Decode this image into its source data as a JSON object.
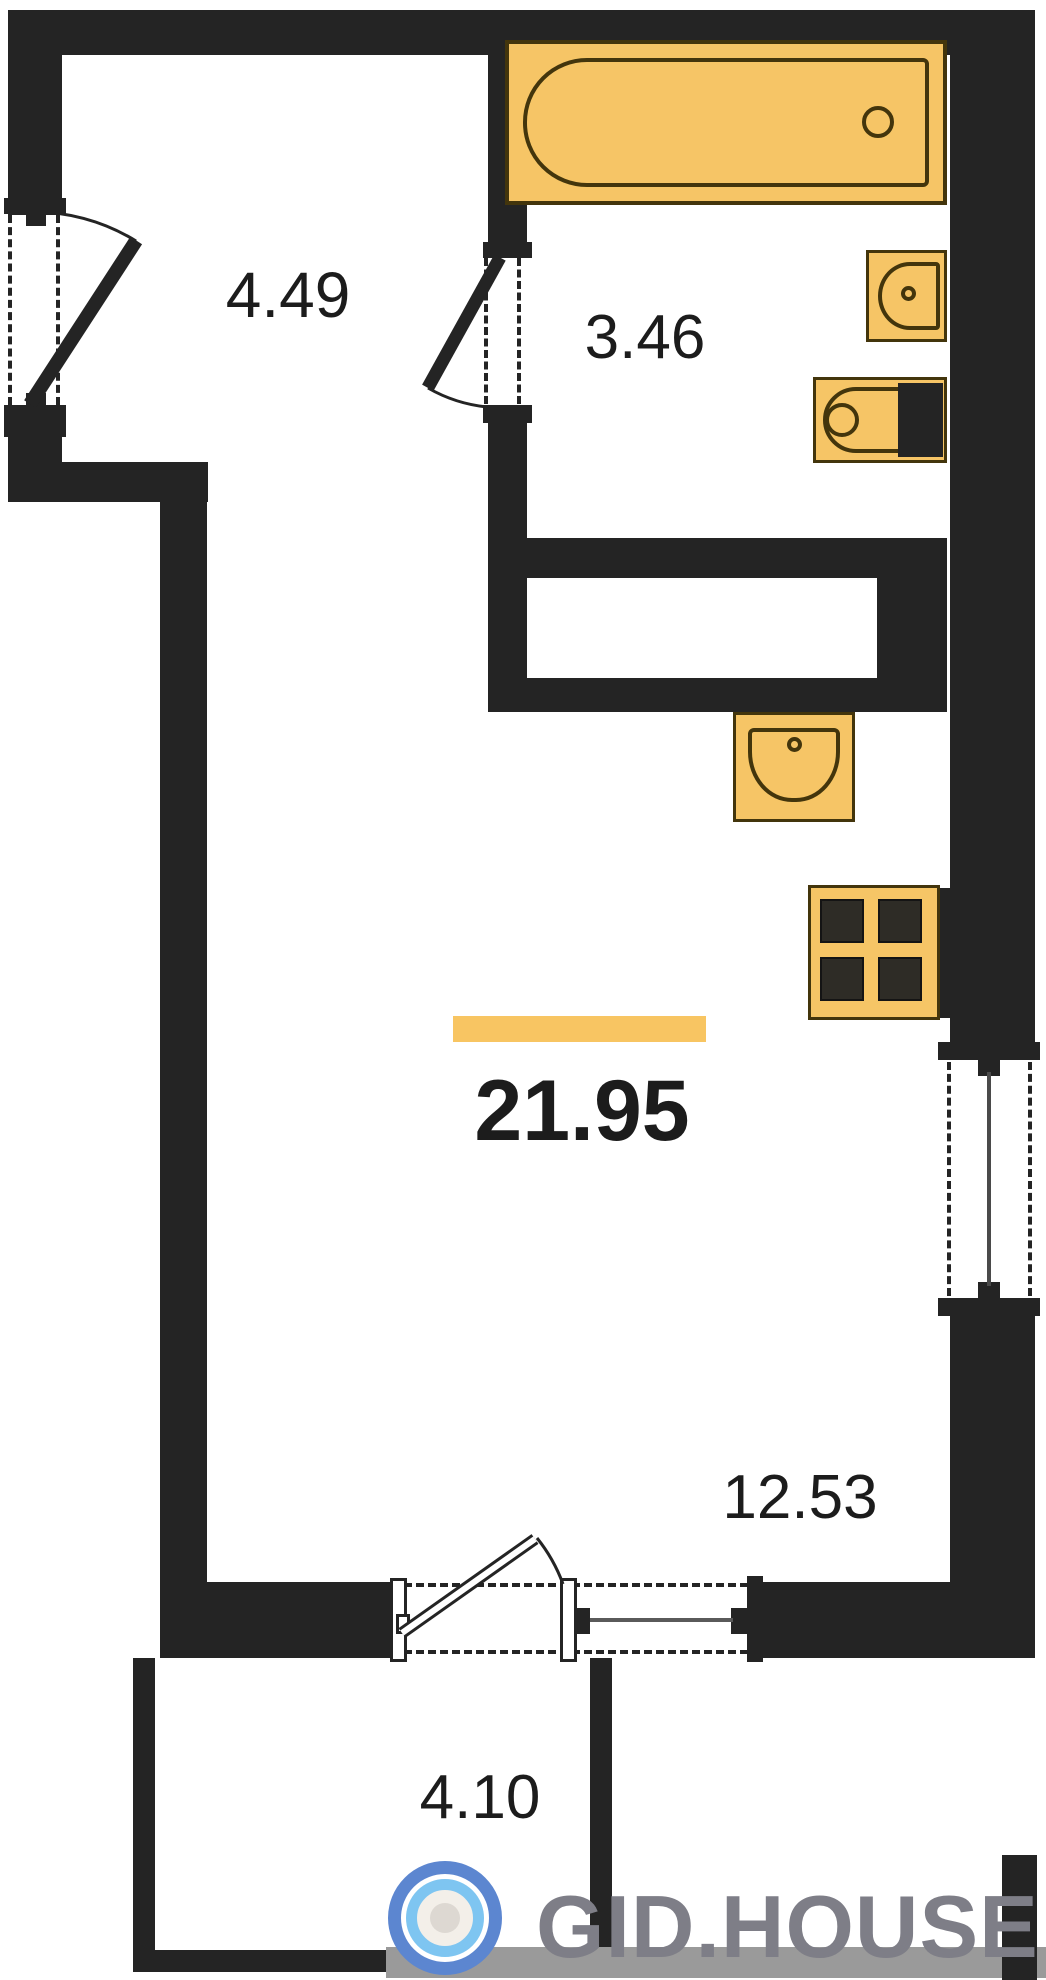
{
  "plan": {
    "type": "apartment-floor-plan",
    "rooms": [
      {
        "name": "entrance-hall",
        "area": "4.49"
      },
      {
        "name": "bathroom",
        "area": "3.46"
      },
      {
        "name": "studio-room-total",
        "area": "21.95"
      },
      {
        "name": "living-zone",
        "area": "12.53"
      },
      {
        "name": "balcony",
        "area": "4.10"
      }
    ],
    "fixtures": [
      "bathtub",
      "wash-basin",
      "toilet",
      "kitchen-sink",
      "stove-4-burner"
    ],
    "openings": [
      "entrance-door",
      "bathroom-door",
      "balcony-door",
      "balcony-window",
      "right-wall-window"
    ],
    "colors": {
      "wall": "#242424",
      "fixture_fill": "#f6c566",
      "fixture_stroke": "#43350c",
      "area_highlight_bar": "#f8c562",
      "watermark_band": "#9a9a9a",
      "watermark_text": "#7e7e87",
      "logo_outer_blue": "#5c86d0",
      "logo_inner_blue": "#7ec5f1"
    }
  },
  "watermark": {
    "brand": "GID.HOUSE",
    "logo": "concentric-rings"
  }
}
